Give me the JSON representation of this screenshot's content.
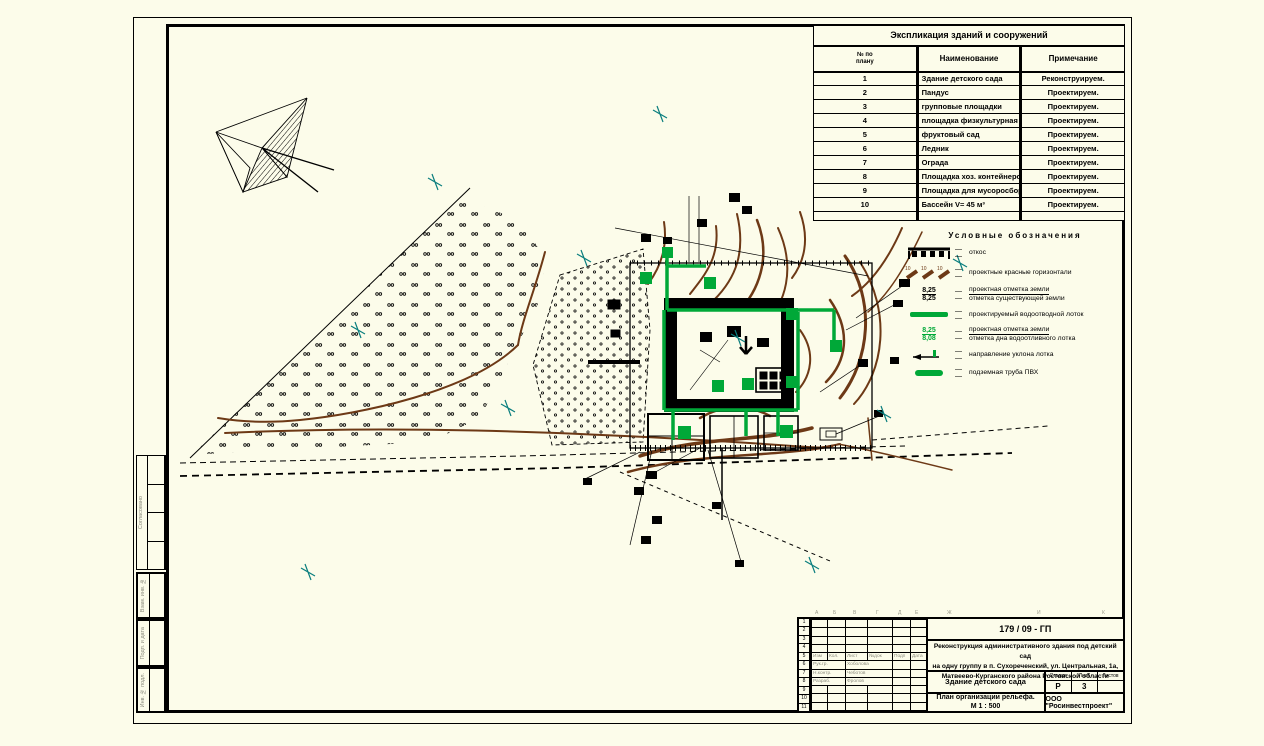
{
  "sheet": {
    "side_stamp": {
      "approved": "Согласовано",
      "vzam": "Взам. инв. №",
      "podp": "Подп. и дата",
      "inv": "Инв. № подл."
    }
  },
  "explication_table": {
    "title": "Экспликация зданий и сооружений",
    "columns": {
      "num": "№ по\nплану",
      "name": "Наименование",
      "note": "Примечание"
    },
    "rows": [
      {
        "num": "1",
        "name": "Здание детского сада",
        "note": "Реконструируем."
      },
      {
        "num": "2",
        "name": "Пандус",
        "note": "Проектируем."
      },
      {
        "num": "3",
        "name": "групповые площадки",
        "note": "Проектируем."
      },
      {
        "num": "4",
        "name": "площадка физкультурная",
        "note": "Проектируем."
      },
      {
        "num": "5",
        "name": "фруктовый сад",
        "note": "Проектируем."
      },
      {
        "num": "6",
        "name": "Ледник",
        "note": "Проектируем."
      },
      {
        "num": "7",
        "name": "Ограда",
        "note": "Проектируем."
      },
      {
        "num": "8",
        "name": "Площадка хоз. контейнеров",
        "note": "Проектируем."
      },
      {
        "num": "9",
        "name": "Площадка для мусоросборника",
        "note": "Проектируем."
      },
      {
        "num": "10",
        "name": "Бассейн V= 45 м³",
        "note": "Проектируем."
      }
    ]
  },
  "legend": {
    "title": "Условные обозначения",
    "contour_tick": "10",
    "items": [
      {
        "label": "откос"
      },
      {
        "label": "проектные красные горизонтали"
      },
      {
        "top": "8,25",
        "bottom": "8,25",
        "label1": "проектная отметка земли",
        "label2": "отметка существующей земли"
      },
      {
        "label": "проектируемый водоотводной лоток"
      },
      {
        "top": "8,25",
        "bottom": "8,08",
        "label1": "проектная отметка земли",
        "label2": "отметка дна водоотливного лотка"
      },
      {
        "label": "направление уклона лотка"
      },
      {
        "label": "подземная труба ПВХ"
      }
    ]
  },
  "title_block": {
    "doc_number": "179 / 09 - ГП",
    "project_line1": "Реконструкция административного здания под детский сад",
    "project_line2": "на одну группу в п. Сухореченский, ул. Центральная, 1а,",
    "project_line3": "Матвеево-Курганского района Ростовской области",
    "object_name": "Здание детского сада",
    "stage_label": "Стадия",
    "sheet_label": "Лист",
    "sheets_label": "Листов",
    "stage": "Р",
    "sheet_num": "3",
    "drawing_title_line1": "План организации рельефа.",
    "drawing_title_line2": "М 1 : 500",
    "company": "ООО \"Росинвестпроект\"",
    "sig_header": [
      "Изм",
      "Кол.",
      "Лист",
      "№док",
      "Подп",
      "Дата"
    ],
    "signatures": [
      {
        "role": "Рук.гр.",
        "name": "Хоболова"
      },
      {
        "role": "Н.контр.",
        "name": "Чеботов"
      },
      {
        "role": "Разраб.",
        "name": "Фролов"
      }
    ],
    "row_numbers": [
      "1",
      "2",
      "3",
      "4",
      "5",
      "6",
      "7",
      "8",
      "9",
      "10",
      "11"
    ],
    "col_letters": [
      "А",
      "Б",
      "В",
      "Г",
      "Д",
      "Е",
      "Ж",
      "И",
      "К"
    ]
  },
  "colors": {
    "background": "#fcfcea",
    "drain_green": "#00a838",
    "contour_brown": "#6d3916",
    "grid_cross_teal": "#0a7e7e"
  }
}
